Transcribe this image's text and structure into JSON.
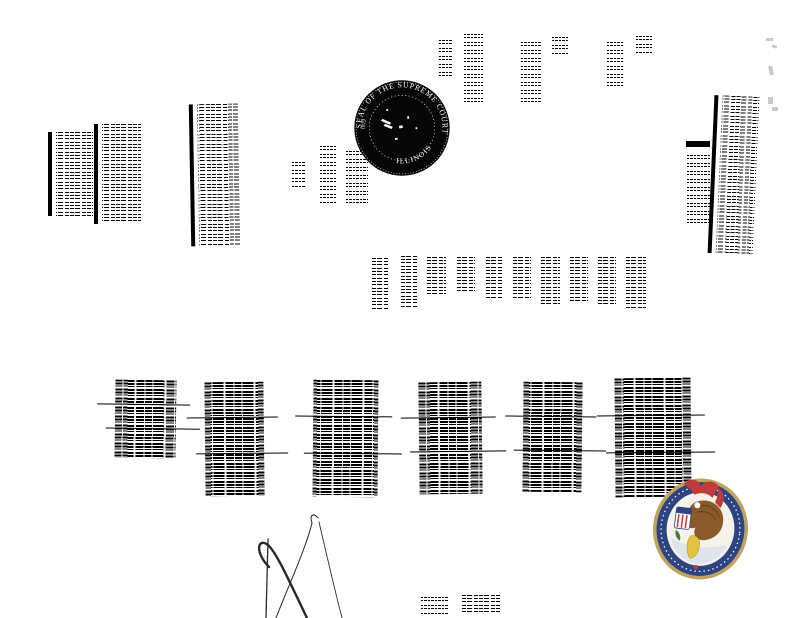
{
  "page": {
    "kind": "Rotated scanned legal document - Supreme Court of Illinois",
    "background": "#ffffff",
    "ink": "#000000",
    "note": "Body text is rotated 90 degrees and too degraded to read"
  },
  "supreme_court_seal": {
    "ring_text": "SEAL OF THE SUPREME COURT",
    "bottom_text": "ILLINOIS",
    "year": "1819",
    "ink": "#060606",
    "text_color": "#ffffff"
  },
  "illinois_state_seal": {
    "rim": "#c0a35e",
    "ring": "#2e4480",
    "field": "#f5f2ea",
    "eagle": "#8a5a2b",
    "eagle_dark": "#6e4216",
    "ribbon": "#c23b3b",
    "shield_gold": "#e2c23f",
    "sprig_green": "#55784a",
    "water": "#dde4ec"
  },
  "signature": {
    "ink": "#2a2a2a"
  }
}
